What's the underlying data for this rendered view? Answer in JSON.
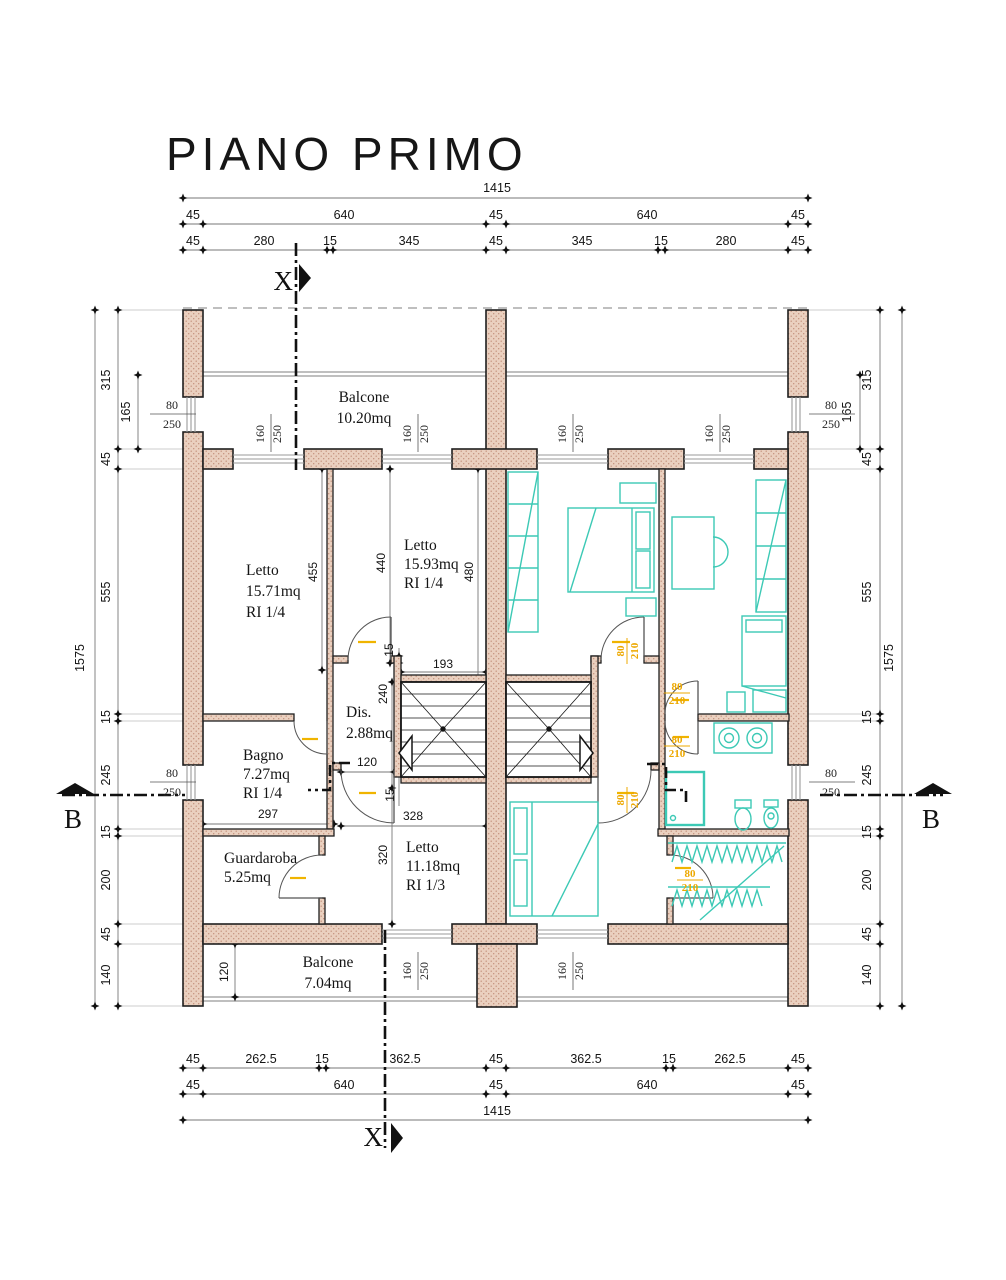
{
  "title": "PIANO PRIMO",
  "section_markers": {
    "x_label": "X",
    "b_label": "B"
  },
  "dimensions": {
    "top": {
      "total": "1415",
      "row2": [
        "45",
        "640",
        "45",
        "640",
        "45"
      ],
      "row3": [
        "45",
        "280",
        "15",
        "345",
        "45",
        "345",
        "15",
        "280",
        "45"
      ]
    },
    "bottom": {
      "row1": [
        "45",
        "262.5",
        "15",
        "362.5",
        "45",
        "362.5",
        "15",
        "262.5",
        "45"
      ],
      "row2": [
        "45",
        "640",
        "45",
        "640",
        "45"
      ],
      "total": "1415"
    },
    "left": {
      "outer": "1575",
      "chain": [
        "315",
        "45",
        "555",
        "15",
        "245",
        "15",
        "200",
        "45",
        "140"
      ],
      "sub": "165"
    },
    "right": {
      "outer": "1575",
      "chain": [
        "315",
        "45",
        "555",
        "15",
        "245",
        "15",
        "200",
        "45",
        "140"
      ],
      "sub": "165"
    },
    "interior": {
      "letto1_side": "455",
      "letto2_side": "440",
      "letto2_side2": "480",
      "wall_a": "15",
      "stair_w": "193",
      "dis_h": "240",
      "door_w": "120",
      "wall_b": "15",
      "letto3_w": "328",
      "letto3_h": "320",
      "bagno_w": "297",
      "balcone_d": "120"
    }
  },
  "openings": {
    "window": {
      "w": "160",
      "h": "250"
    },
    "door": {
      "w": "80",
      "h": "210"
    },
    "side": {
      "w": "80",
      "h": "250"
    }
  },
  "rooms": {
    "balcone_top": {
      "name": "Balcone",
      "area": "10.20mq"
    },
    "letto1": {
      "name": "Letto",
      "area": "15.71mq",
      "ri": "RI 1/4"
    },
    "letto2": {
      "name": "Letto",
      "area": "15.93mq",
      "ri": "RI 1/4"
    },
    "dis": {
      "name": "Dis.",
      "area": "2.88mq"
    },
    "bagno": {
      "name": "Bagno",
      "area": "7.27mq",
      "ri": "RI 1/4"
    },
    "guardaroba": {
      "name": "Guardaroba",
      "area": "5.25mq"
    },
    "letto3": {
      "name": "Letto",
      "area": "11.18mq",
      "ri": "RI 1/3"
    },
    "balcone_bottom": {
      "name": "Balcone",
      "area": "7.04mq"
    }
  },
  "colors": {
    "wall_fill": "#ead0bf",
    "wall_dot": "#c2907c",
    "furniture": "#3cc9b5",
    "door_label": "#eda800",
    "ink": "#111111",
    "dim_line": "#777777"
  }
}
